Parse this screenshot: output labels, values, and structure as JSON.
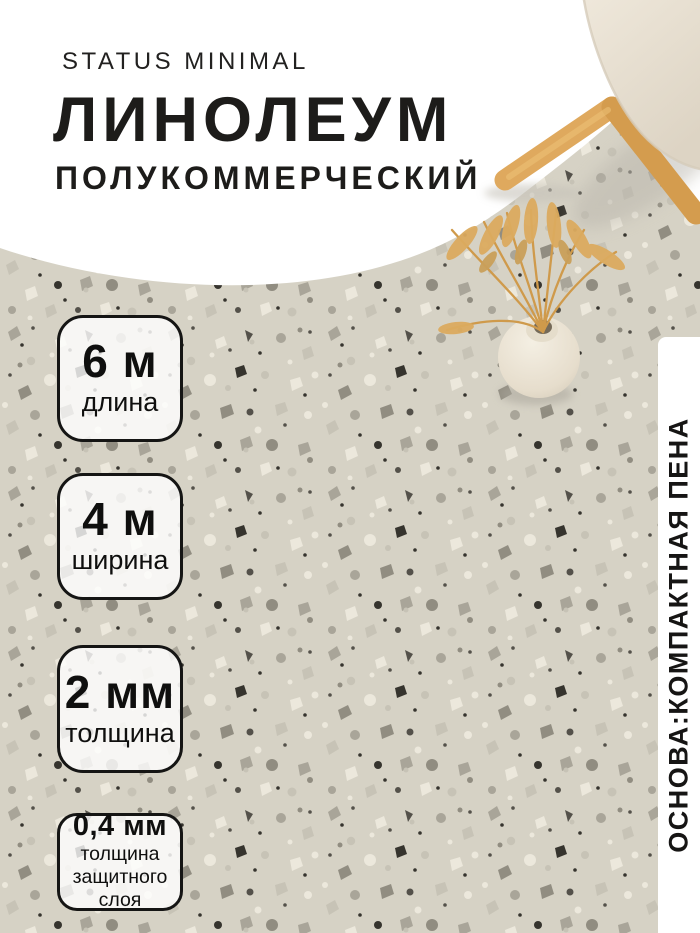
{
  "brand": "STATUS MINIMAL",
  "product": {
    "title": "ЛИНОЛЕУМ",
    "subtitle": "ПОЛУКОММЕРЧЕСКИЙ"
  },
  "specs": [
    {
      "value": "6 м",
      "label": "длина"
    },
    {
      "value": "4 м",
      "label": "ширина"
    },
    {
      "value": "2 мм",
      "label": "толщина"
    },
    {
      "value": "0,4 мм",
      "label": "толщина защитного слоя",
      "label_lines": [
        "толщина",
        "защитного",
        "слоя"
      ]
    }
  ],
  "side_note": "ОСНОВА:КОМПАКТНАЯ ПЕНА",
  "scene": {
    "objects": [
      "terrazzo-linoleum-floor",
      "beige-chair-with-wooden-legs",
      "round-vase-with-dried-wheat"
    ],
    "colors": {
      "background": "#ffffff",
      "floor_base": "#d6d2c5",
      "chip_dark": "#36342e",
      "chip_light": "#ece8dc",
      "wood": "#dca75c",
      "cushion": "#e9e2d4",
      "text": "#1d1c1a"
    }
  }
}
